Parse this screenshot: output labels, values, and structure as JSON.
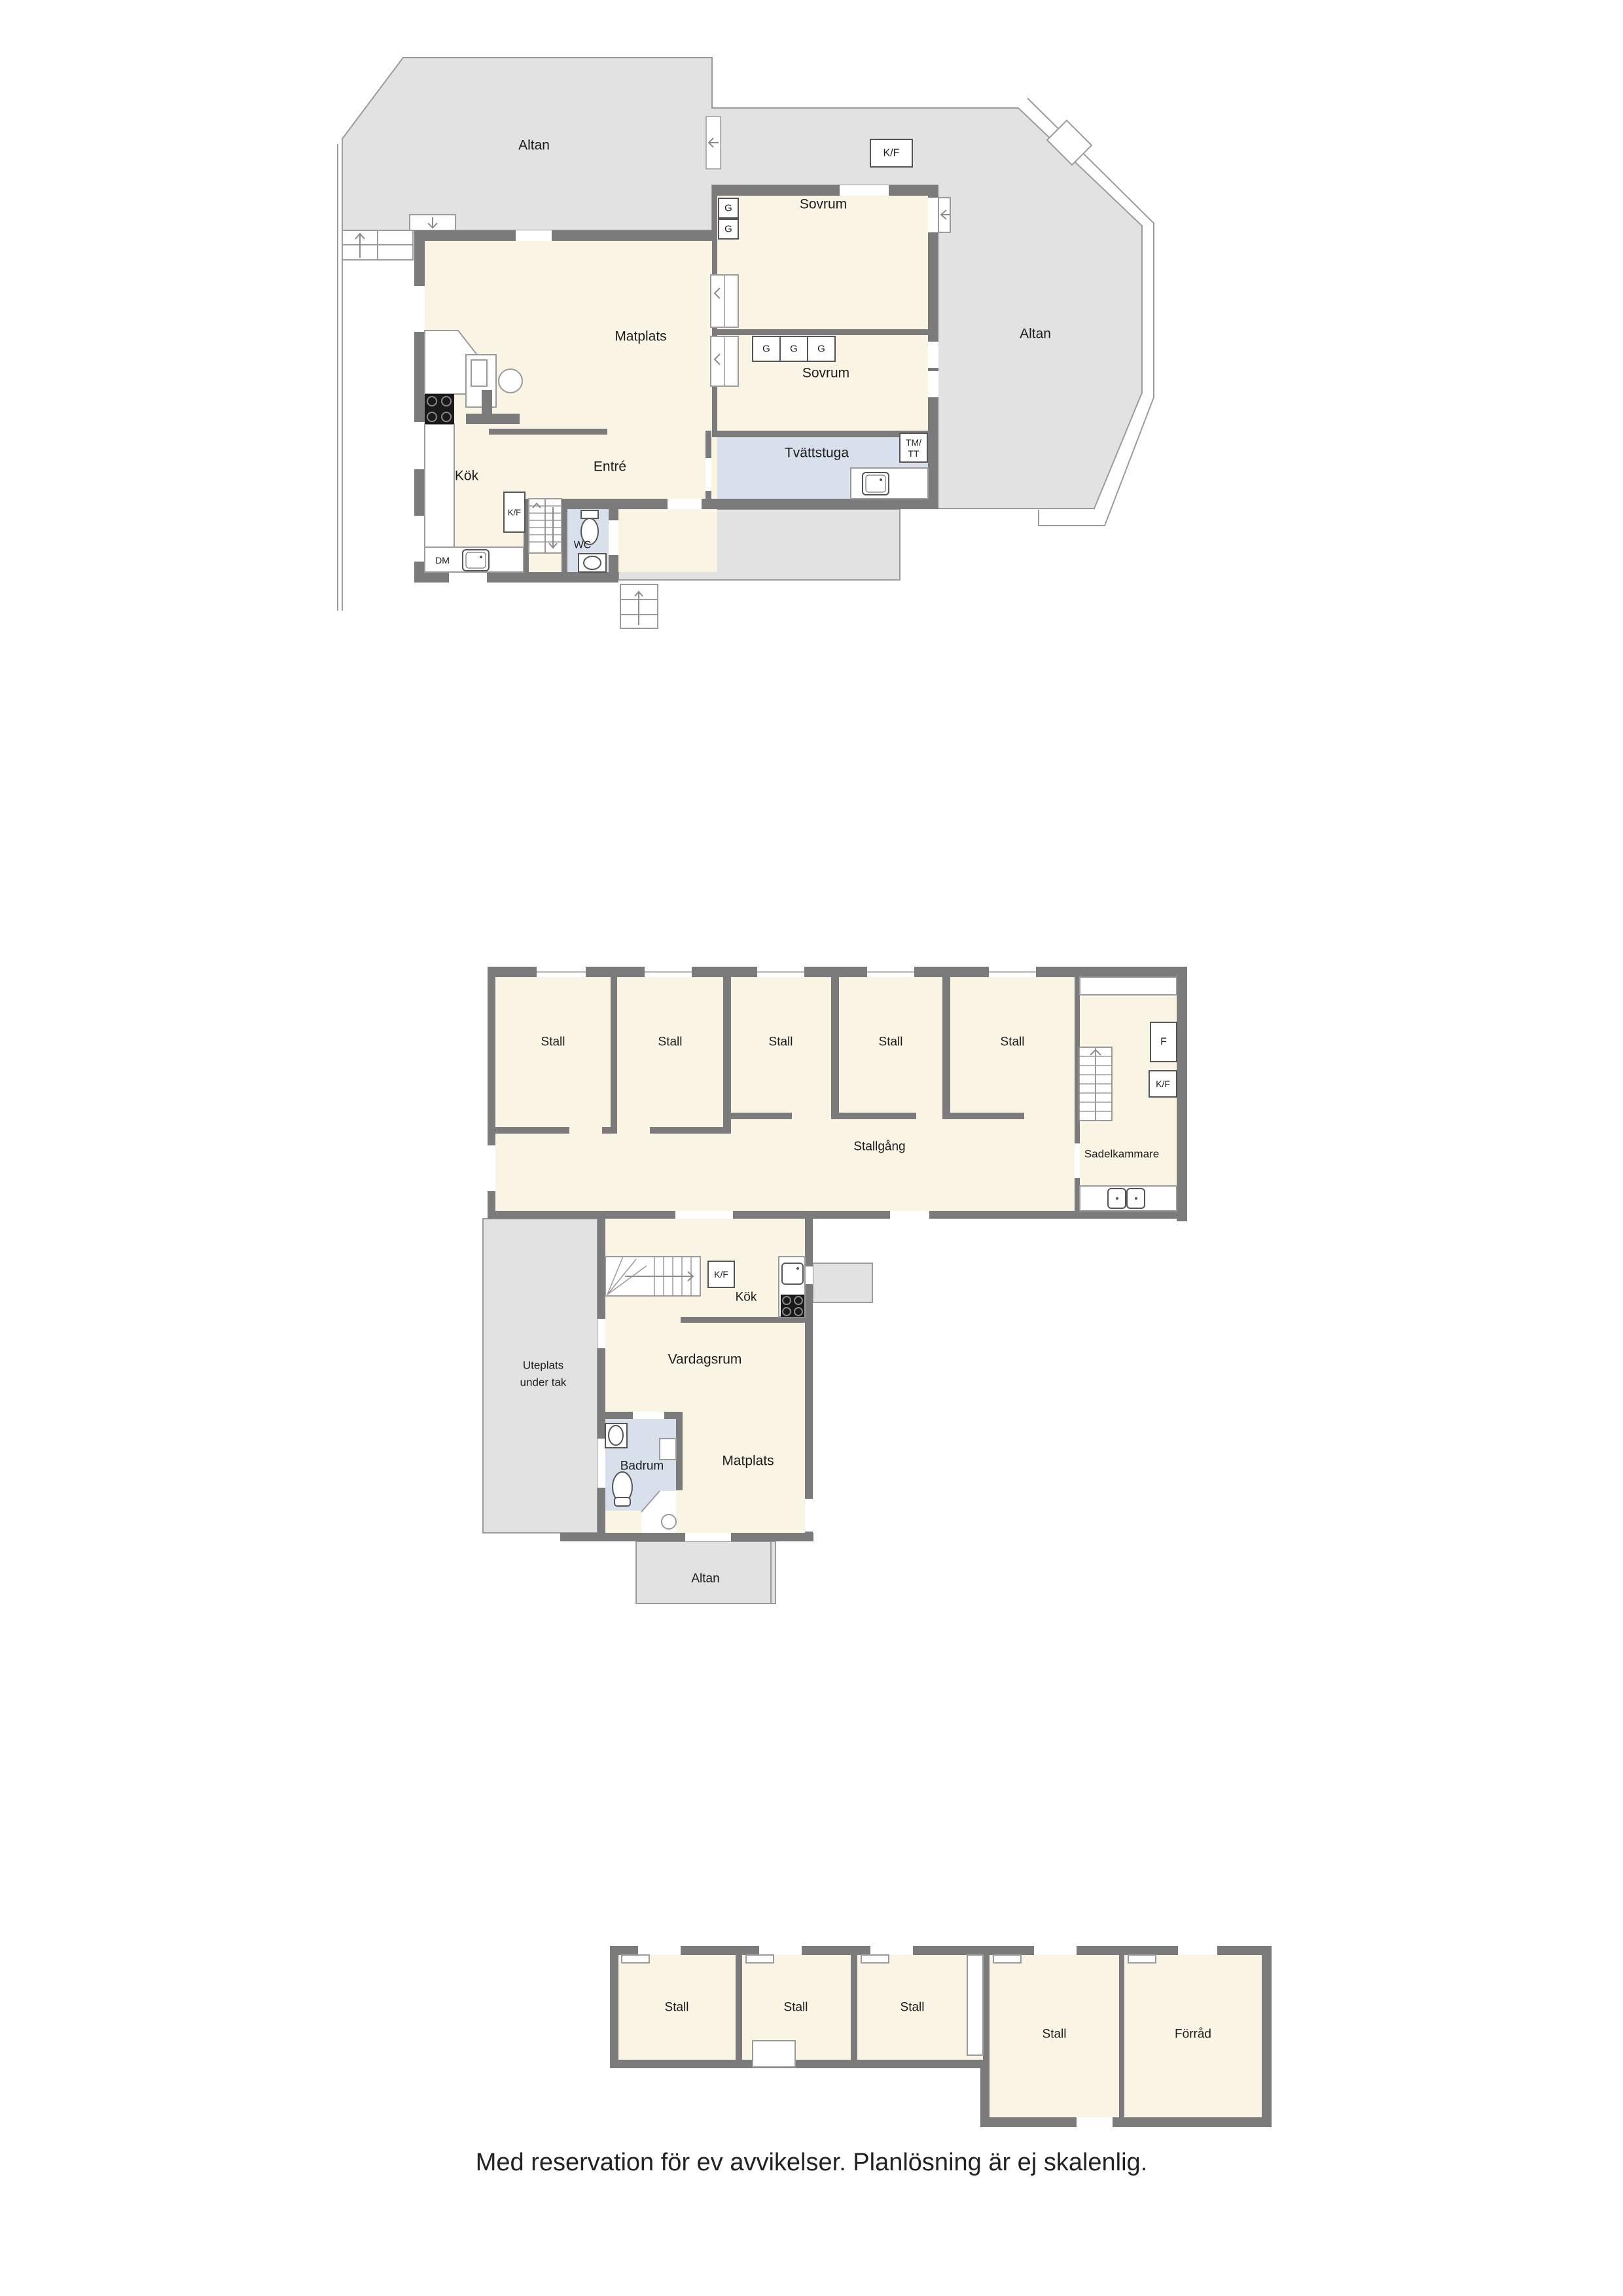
{
  "floorplans": {
    "house": {
      "altan_left": "Altan",
      "altan_right": "Altan",
      "kf_outside": "K/F",
      "g": "G",
      "sovrum_1": "Sovrum",
      "sovrum_2": "Sovrum",
      "matplats": "Matplats",
      "kok": "Kök",
      "entre": "Entré",
      "tvattstuga": "Tvättstuga",
      "tm_tt_line1": "TM/",
      "tm_tt_line2": "TT",
      "wc": "WC",
      "dm": "DM",
      "kf_kitchen": "K/F"
    },
    "stable": {
      "stall": "Stall",
      "stallgang": "Stallgång",
      "sadelkammare": "Sadelkammare",
      "f": "F",
      "kf": "K/F",
      "kf_kitchen": "K/F",
      "kok": "Kök",
      "uteplats_line1": "Uteplats",
      "uteplats_line2": "under tak",
      "vardagsrum": "Vardagsrum",
      "badrum": "Badrum",
      "matplats": "Matplats",
      "altan": "Altan"
    },
    "outbuilding": {
      "stall": "Stall",
      "forrad": "Förråd"
    },
    "disclaimer": "Med reservation för ev avvikelser. Planlösning är ej skalenlig."
  }
}
